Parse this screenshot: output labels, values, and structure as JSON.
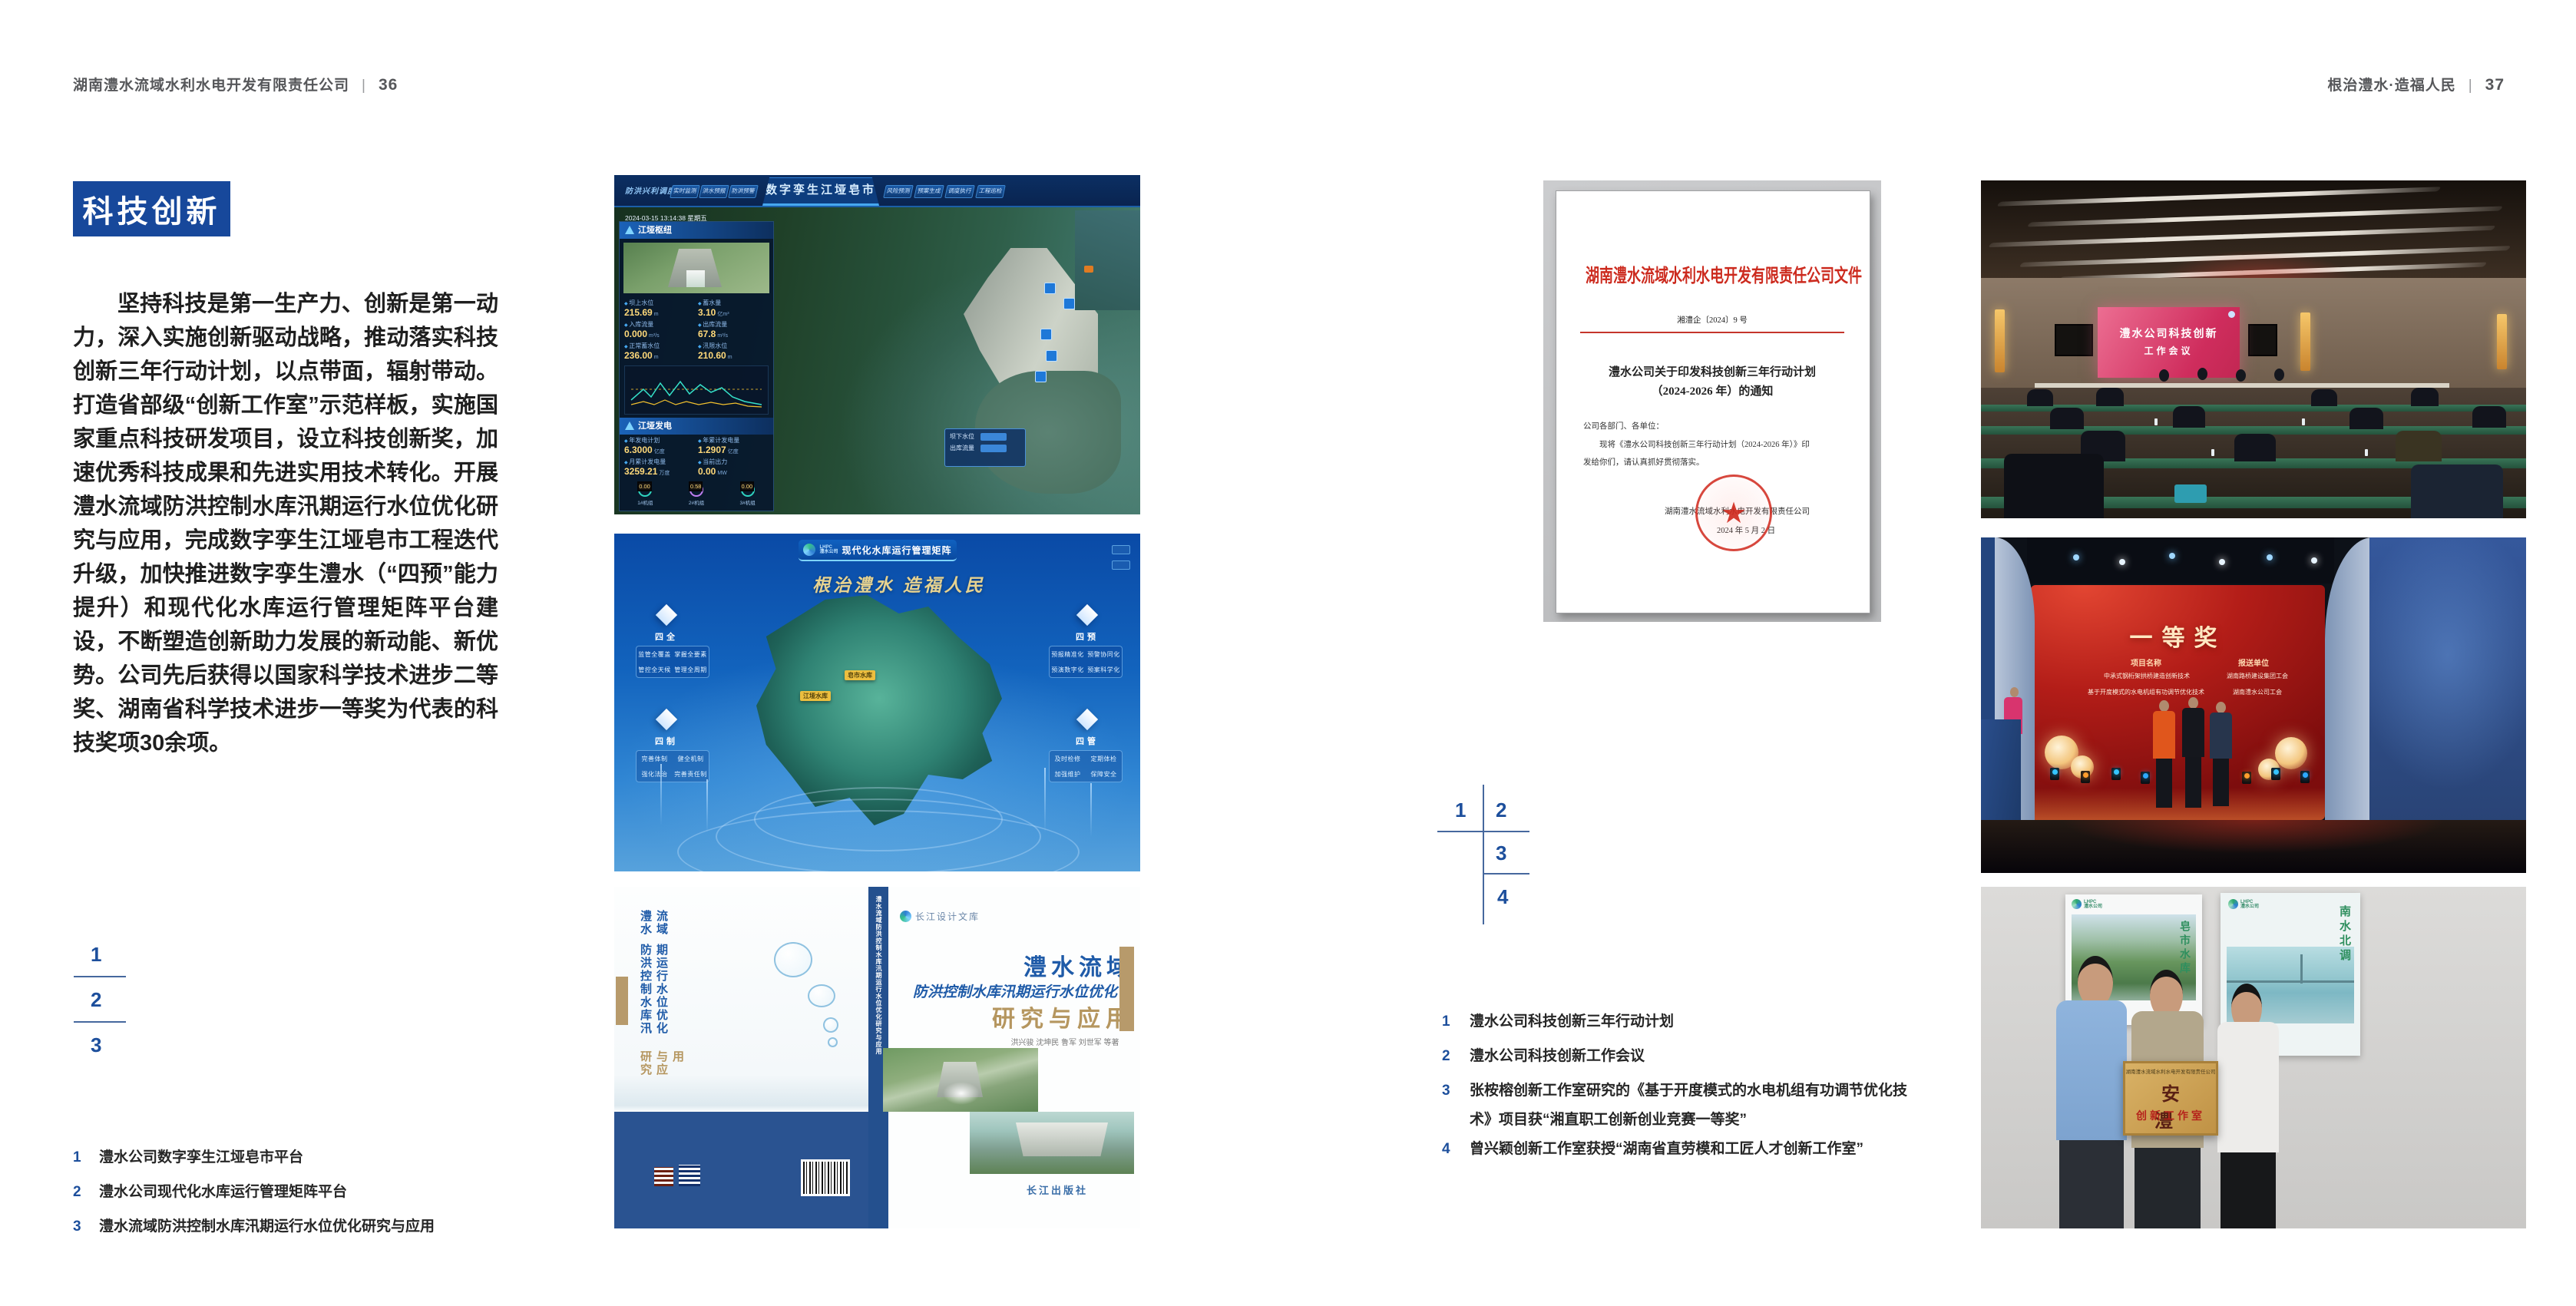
{
  "page_left": {
    "header": {
      "company": "湖南澧水流域水利水电开发有限责任公司",
      "separator": "|",
      "page_number": "36"
    },
    "section_badge": "科技创新",
    "body_paragraph": "坚持科技是第一生产力、创新是第一动力，深入实施创新驱动战略，推动落实科技创新三年行动计划，以点带面，辐射带动。打造省部级“创新工作室”示范样板，实施国家重点科技研发项目，设立科技创新奖，加速优秀科技成果和先进实用技术转化。开展澧水流域防洪控制水库汛期运行水位优化研究与应用，完成数字孪生江垭皂市工程迭代升级，加快推进数字孪生澧水（“四预”能力提升）和现代化水库运行管理矩阵平台建设，不断塑造创新助力发展的新动能、新优势。公司先后获得以国家科学技术进步二等奖、湖南省科学技术进步一等奖为代表的科技奖项30余项。",
    "figure_index": {
      "n1": "1",
      "n2": "2",
      "n3": "3"
    },
    "captions": [
      {
        "num": "1",
        "text": "澧水公司数字孪生江垭皂市平台"
      },
      {
        "num": "2",
        "text": "澧水公司现代化水库运行管理矩阵平台"
      },
      {
        "num": "3",
        "text": "澧水流域防洪控制水库汛期运行水位优化研究与应用"
      }
    ]
  },
  "figure_digital_twin": {
    "system_label": "防洪兴利调度",
    "title": "数字孪生江垭皂市",
    "tabs_left": [
      "实时监测",
      "洪水预报",
      "防洪预警"
    ],
    "tabs_right": [
      "风险预测",
      "预案生成",
      "调度执行",
      "工程巡检"
    ],
    "timestamp": "2024-03-15 13:14:38 星期五",
    "panel1_title": "江垭枢纽",
    "metrics": [
      {
        "label": "坝上水位",
        "value": "215.69",
        "unit": "m"
      },
      {
        "label": "蓄水量",
        "value": "3.10",
        "unit": "亿m³"
      },
      {
        "label": "入库流量",
        "value": "0.000",
        "unit": "m³/s"
      },
      {
        "label": "出库流量",
        "value": "67.8",
        "unit": "m³/s"
      },
      {
        "label": "正常蓄水位",
        "value": "236.00",
        "unit": "m"
      },
      {
        "label": "汛限水位",
        "value": "210.60",
        "unit": "m"
      }
    ],
    "panel2_title": "江垭发电",
    "metrics2": [
      {
        "label": "年发电计划",
        "value": "6.3000",
        "unit": "亿度"
      },
      {
        "label": "年累计发电量",
        "value": "1.2907",
        "unit": "亿度"
      },
      {
        "label": "月累计发电量",
        "value": "3259.21",
        "unit": "万度"
      },
      {
        "label": "当前出力",
        "value": "0.00",
        "unit": "MW"
      }
    ],
    "turbines": [
      {
        "label": "1#机组",
        "value": "0.00"
      },
      {
        "label": "2#机组",
        "value": "0.58"
      },
      {
        "label": "3#机组",
        "value": "0.00"
      }
    ],
    "tooltip": {
      "row1_label": "坝下水位",
      "row2_label": "出库流量"
    }
  },
  "figure_matrix": {
    "logo_line1": "LHPC",
    "logo_line2": "澧水公司",
    "title": "现代化水库运行管理矩阵",
    "slogan": "根治澧水 造福人民",
    "panels": [
      {
        "name": "四全",
        "items": [
          "监管全覆盖",
          "掌握全要素",
          "管控全天候",
          "管理全周期"
        ]
      },
      {
        "name": "四预",
        "items": [
          "预报精准化",
          "预警协同化",
          "预演数字化",
          "预案科学化"
        ]
      },
      {
        "name": "四制",
        "items": [
          "完善体制",
          "健全机制",
          "强化法治",
          "完善责任制"
        ]
      },
      {
        "name": "四管",
        "items": [
          "及时检修",
          "定期体检",
          "加强维护",
          "保障安全"
        ]
      }
    ],
    "map_labels": [
      "皂市水库",
      "江垭水库"
    ]
  },
  "figure_book": {
    "series_badge": "长江设计文库",
    "title_main": "澧水流域",
    "title_sub": "防洪控制水库汛期运行水位优化",
    "title_tail": "研究与应用",
    "authors": "洪兴骏 沈坤民 鲁军 刘世军 等著",
    "publisher": "长江出版社",
    "spine_text": "澧水流域防洪控制水库汛期运行水位优化研究与应用"
  },
  "page_right": {
    "header": {
      "slogan": "根治澧水·造福人民",
      "separator": "|",
      "page_number": "37"
    },
    "document": {
      "red_title": "湖南澧水流域水利水电开发有限责任公司文件",
      "doc_number": "湘澧企〔2024〕9 号",
      "notice_title_line1": "澧水公司关于印发科技创新三年行动计划",
      "notice_title_line2": "（2024-2026 年）的通知",
      "salutation": "公司各部门、各单位：",
      "body_line1": "现将《澧水公司科技创新三年行动计划（2024-2026 年）》印",
      "body_line2": "发给你们，请认真抓好贯彻落实。",
      "signature": "湖南澧水流域水利水电开发有限责任公司",
      "date": "2024 年 5 月 2 日"
    },
    "figure_index": {
      "n1": "1",
      "n2": "2",
      "n3": "3",
      "n4": "4"
    },
    "captions": [
      {
        "num": "1",
        "text": "澧水公司科技创新三年行动计划"
      },
      {
        "num": "2",
        "text": "澧水公司科技创新工作会议"
      },
      {
        "num": "3",
        "text": "张桉榕创新工作室研究的《基于开度模式的水电机组有功调节优化技术》项目获“湘直职工创新创业竞赛一等奖”"
      },
      {
        "num": "4",
        "text": "曾兴颖创新工作室获授“湖南省直劳模和工匠人才创新工作室”"
      }
    ],
    "photo_meeting": {
      "screen_line1": "澧水公司科技创新",
      "screen_line2": "工作会议"
    },
    "photo_award": {
      "screen_title": "一等奖",
      "col1_header": "项目名称",
      "col2_header": "报送单位",
      "col1_rows": [
        "中承式钢桁架拱桥建造创新技术",
        "基于开度模式的水电机组有功调节优化技术"
      ],
      "col2_rows": [
        "湖南路桥建设集团工会",
        "湖南澧水公司工会"
      ]
    },
    "photo_plaque": {
      "plaque_header": "湖南澧水流域水利水电开发有限责任公司",
      "plaque_title": "安　澧",
      "plaque_subtitle": "创新工作室",
      "poster_left_text": "皂市水库",
      "poster_right_text": "南水北调"
    }
  }
}
